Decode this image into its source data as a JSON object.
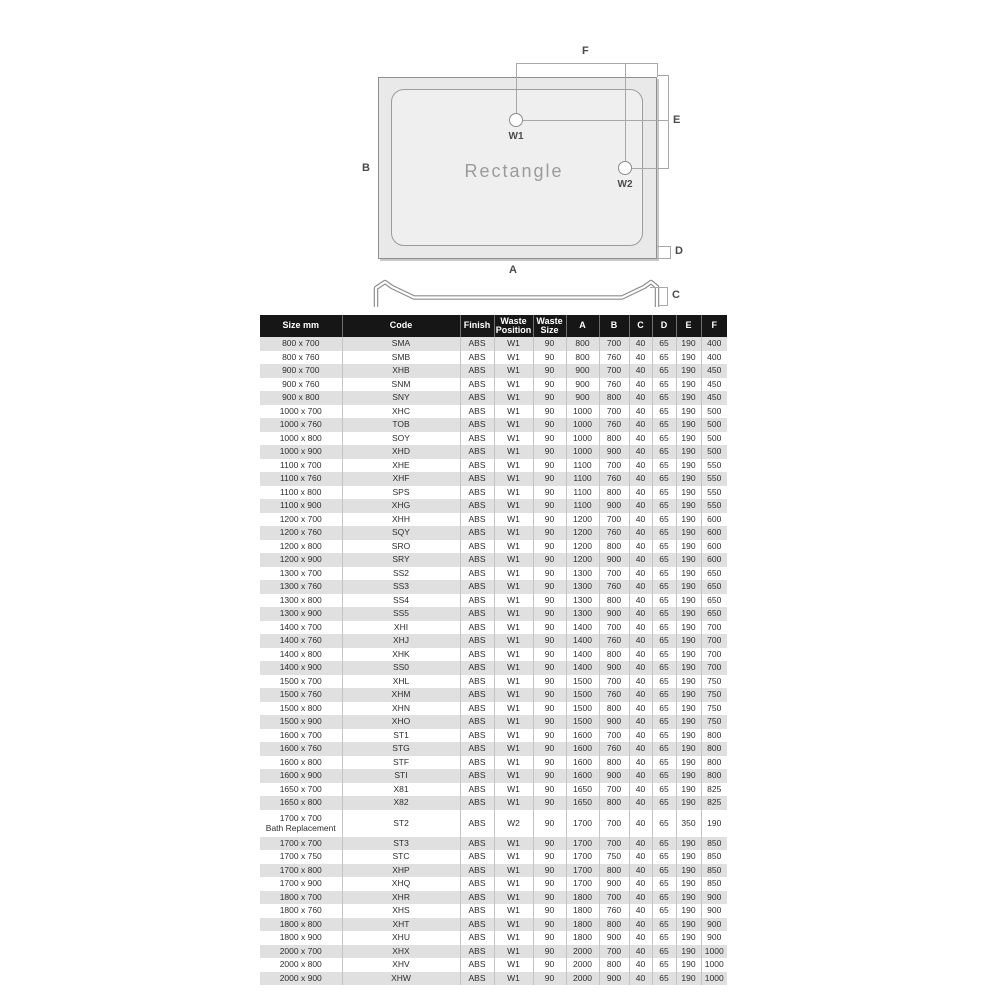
{
  "diagram": {
    "shape_label": "Rectangle",
    "waste_markers": {
      "w1": "W1",
      "w2": "W2"
    },
    "dimension_labels": {
      "A": "A",
      "B": "B",
      "C": "C",
      "D": "D",
      "E": "E",
      "F": "F"
    }
  },
  "colors": {
    "header_bg": "#161616",
    "header_text": "#ffffff",
    "row_stripe": "#e0e0e0",
    "row_text": "#2e2e2e",
    "diagram_fill": "#e9e9e9",
    "diagram_line": "#8f8f8f",
    "dim_line": "#a8a8a8",
    "label_text": "#4a4a4a"
  },
  "table": {
    "columns": [
      "Size mm",
      "Code",
      "Finish",
      "Waste|Position",
      "Waste|Size",
      "A",
      "B",
      "C",
      "D",
      "E",
      "F"
    ],
    "rows": [
      [
        "800 x 700",
        "SMA",
        "ABS",
        "W1",
        "90",
        "800",
        "700",
        "40",
        "65",
        "190",
        "400"
      ],
      [
        "800 x 760",
        "SMB",
        "ABS",
        "W1",
        "90",
        "800",
        "760",
        "40",
        "65",
        "190",
        "400"
      ],
      [
        "900 x 700",
        "XHB",
        "ABS",
        "W1",
        "90",
        "900",
        "700",
        "40",
        "65",
        "190",
        "450"
      ],
      [
        "900 x 760",
        "SNM",
        "ABS",
        "W1",
        "90",
        "900",
        "760",
        "40",
        "65",
        "190",
        "450"
      ],
      [
        "900 x 800",
        "SNY",
        "ABS",
        "W1",
        "90",
        "900",
        "800",
        "40",
        "65",
        "190",
        "450"
      ],
      [
        "1000 x 700",
        "XHC",
        "ABS",
        "W1",
        "90",
        "1000",
        "700",
        "40",
        "65",
        "190",
        "500"
      ],
      [
        "1000 x 760",
        "TOB",
        "ABS",
        "W1",
        "90",
        "1000",
        "760",
        "40",
        "65",
        "190",
        "500"
      ],
      [
        "1000 x 800",
        "SOY",
        "ABS",
        "W1",
        "90",
        "1000",
        "800",
        "40",
        "65",
        "190",
        "500"
      ],
      [
        "1000 x 900",
        "XHD",
        "ABS",
        "W1",
        "90",
        "1000",
        "900",
        "40",
        "65",
        "190",
        "500"
      ],
      [
        "1100 x 700",
        "XHE",
        "ABS",
        "W1",
        "90",
        "1100",
        "700",
        "40",
        "65",
        "190",
        "550"
      ],
      [
        "1100 x 760",
        "XHF",
        "ABS",
        "W1",
        "90",
        "1100",
        "760",
        "40",
        "65",
        "190",
        "550"
      ],
      [
        "1100 x 800",
        "SPS",
        "ABS",
        "W1",
        "90",
        "1100",
        "800",
        "40",
        "65",
        "190",
        "550"
      ],
      [
        "1100 x 900",
        "XHG",
        "ABS",
        "W1",
        "90",
        "1100",
        "900",
        "40",
        "65",
        "190",
        "550"
      ],
      [
        "1200 x 700",
        "XHH",
        "ABS",
        "W1",
        "90",
        "1200",
        "700",
        "40",
        "65",
        "190",
        "600"
      ],
      [
        "1200 x 760",
        "SQY",
        "ABS",
        "W1",
        "90",
        "1200",
        "760",
        "40",
        "65",
        "190",
        "600"
      ],
      [
        "1200 x 800",
        "SRO",
        "ABS",
        "W1",
        "90",
        "1200",
        "800",
        "40",
        "65",
        "190",
        "600"
      ],
      [
        "1200 x 900",
        "SRY",
        "ABS",
        "W1",
        "90",
        "1200",
        "900",
        "40",
        "65",
        "190",
        "600"
      ],
      [
        "1300 x 700",
        "SS2",
        "ABS",
        "W1",
        "90",
        "1300",
        "700",
        "40",
        "65",
        "190",
        "650"
      ],
      [
        "1300 x 760",
        "SS3",
        "ABS",
        "W1",
        "90",
        "1300",
        "760",
        "40",
        "65",
        "190",
        "650"
      ],
      [
        "1300 x 800",
        "SS4",
        "ABS",
        "W1",
        "90",
        "1300",
        "800",
        "40",
        "65",
        "190",
        "650"
      ],
      [
        "1300 x 900",
        "SS5",
        "ABS",
        "W1",
        "90",
        "1300",
        "900",
        "40",
        "65",
        "190",
        "650"
      ],
      [
        "1400 x 700",
        "XHI",
        "ABS",
        "W1",
        "90",
        "1400",
        "700",
        "40",
        "65",
        "190",
        "700"
      ],
      [
        "1400 x 760",
        "XHJ",
        "ABS",
        "W1",
        "90",
        "1400",
        "760",
        "40",
        "65",
        "190",
        "700"
      ],
      [
        "1400 x 800",
        "XHK",
        "ABS",
        "W1",
        "90",
        "1400",
        "800",
        "40",
        "65",
        "190",
        "700"
      ],
      [
        "1400 x 900",
        "SS0",
        "ABS",
        "W1",
        "90",
        "1400",
        "900",
        "40",
        "65",
        "190",
        "700"
      ],
      [
        "1500 x 700",
        "XHL",
        "ABS",
        "W1",
        "90",
        "1500",
        "700",
        "40",
        "65",
        "190",
        "750"
      ],
      [
        "1500 x 760",
        "XHM",
        "ABS",
        "W1",
        "90",
        "1500",
        "760",
        "40",
        "65",
        "190",
        "750"
      ],
      [
        "1500 x 800",
        "XHN",
        "ABS",
        "W1",
        "90",
        "1500",
        "800",
        "40",
        "65",
        "190",
        "750"
      ],
      [
        "1500 x 900",
        "XHO",
        "ABS",
        "W1",
        "90",
        "1500",
        "900",
        "40",
        "65",
        "190",
        "750"
      ],
      [
        "1600 x 700",
        "ST1",
        "ABS",
        "W1",
        "90",
        "1600",
        "700",
        "40",
        "65",
        "190",
        "800"
      ],
      [
        "1600 x 760",
        "STG",
        "ABS",
        "W1",
        "90",
        "1600",
        "760",
        "40",
        "65",
        "190",
        "800"
      ],
      [
        "1600 x 800",
        "STF",
        "ABS",
        "W1",
        "90",
        "1600",
        "800",
        "40",
        "65",
        "190",
        "800"
      ],
      [
        "1600 x 900",
        "STI",
        "ABS",
        "W1",
        "90",
        "1600",
        "900",
        "40",
        "65",
        "190",
        "800"
      ],
      [
        "1650 x 700",
        "X81",
        "ABS",
        "W1",
        "90",
        "1650",
        "700",
        "40",
        "65",
        "190",
        "825"
      ],
      [
        "1650 x 800",
        "X82",
        "ABS",
        "W1",
        "90",
        "1650",
        "800",
        "40",
        "65",
        "190",
        "825"
      ],
      [
        "1700 x 700|Bath Replacement",
        "ST2",
        "ABS",
        "W2",
        "90",
        "1700",
        "700",
        "40",
        "65",
        "350",
        "190"
      ],
      [
        "1700 x 700",
        "ST3",
        "ABS",
        "W1",
        "90",
        "1700",
        "700",
        "40",
        "65",
        "190",
        "850"
      ],
      [
        "1700 x 750",
        "STC",
        "ABS",
        "W1",
        "90",
        "1700",
        "750",
        "40",
        "65",
        "190",
        "850"
      ],
      [
        "1700 x 800",
        "XHP",
        "ABS",
        "W1",
        "90",
        "1700",
        "800",
        "40",
        "65",
        "190",
        "850"
      ],
      [
        "1700 x 900",
        "XHQ",
        "ABS",
        "W1",
        "90",
        "1700",
        "900",
        "40",
        "65",
        "190",
        "850"
      ],
      [
        "1800 x 700",
        "XHR",
        "ABS",
        "W1",
        "90",
        "1800",
        "700",
        "40",
        "65",
        "190",
        "900"
      ],
      [
        "1800 x 760",
        "XHS",
        "ABS",
        "W1",
        "90",
        "1800",
        "760",
        "40",
        "65",
        "190",
        "900"
      ],
      [
        "1800 x 800",
        "XHT",
        "ABS",
        "W1",
        "90",
        "1800",
        "800",
        "40",
        "65",
        "190",
        "900"
      ],
      [
        "1800 x 900",
        "XHU",
        "ABS",
        "W1",
        "90",
        "1800",
        "900",
        "40",
        "65",
        "190",
        "900"
      ],
      [
        "2000 x 700",
        "XHX",
        "ABS",
        "W1",
        "90",
        "2000",
        "700",
        "40",
        "65",
        "190",
        "1000"
      ],
      [
        "2000 x 800",
        "XHV",
        "ABS",
        "W1",
        "90",
        "2000",
        "800",
        "40",
        "65",
        "190",
        "1000"
      ],
      [
        "2000 x 900",
        "XHW",
        "ABS",
        "W1",
        "90",
        "2000",
        "900",
        "40",
        "65",
        "190",
        "1000"
      ]
    ]
  }
}
